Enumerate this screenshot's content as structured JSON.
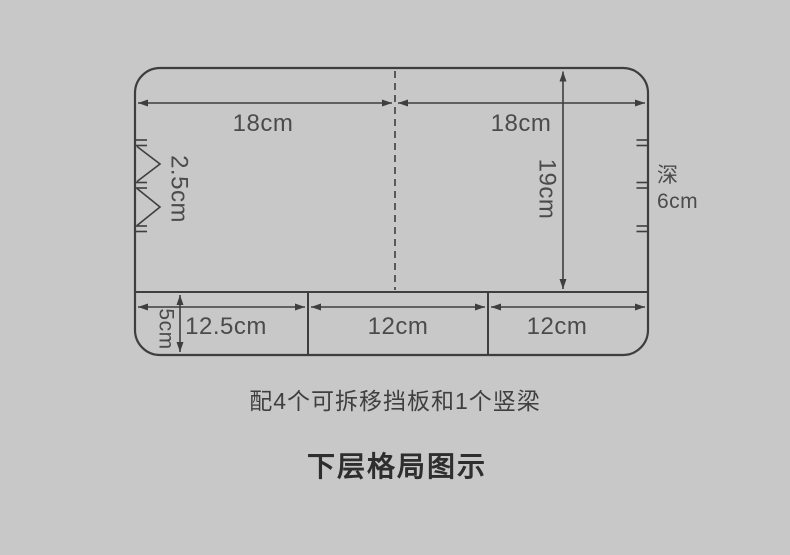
{
  "canvas": {
    "background": "#c8c8c8",
    "line_color": "#3e3e3e",
    "label_color": "#4b4b4b",
    "title_color": "#2e2e2e"
  },
  "diagram": {
    "dimensions": {
      "top_width_left": "18cm",
      "top_width_right": "18cm",
      "slot_pitch": "2.5cm",
      "inner_depth": "19cm",
      "depth_prefix": "深",
      "depth_value": "6cm",
      "bottom_row_height": "5cm",
      "bottom_cells": [
        "12.5cm",
        "12cm",
        "12cm"
      ]
    },
    "caption": "配4个可拆移挡板和1个竖梁",
    "title": "下层格局图示"
  }
}
